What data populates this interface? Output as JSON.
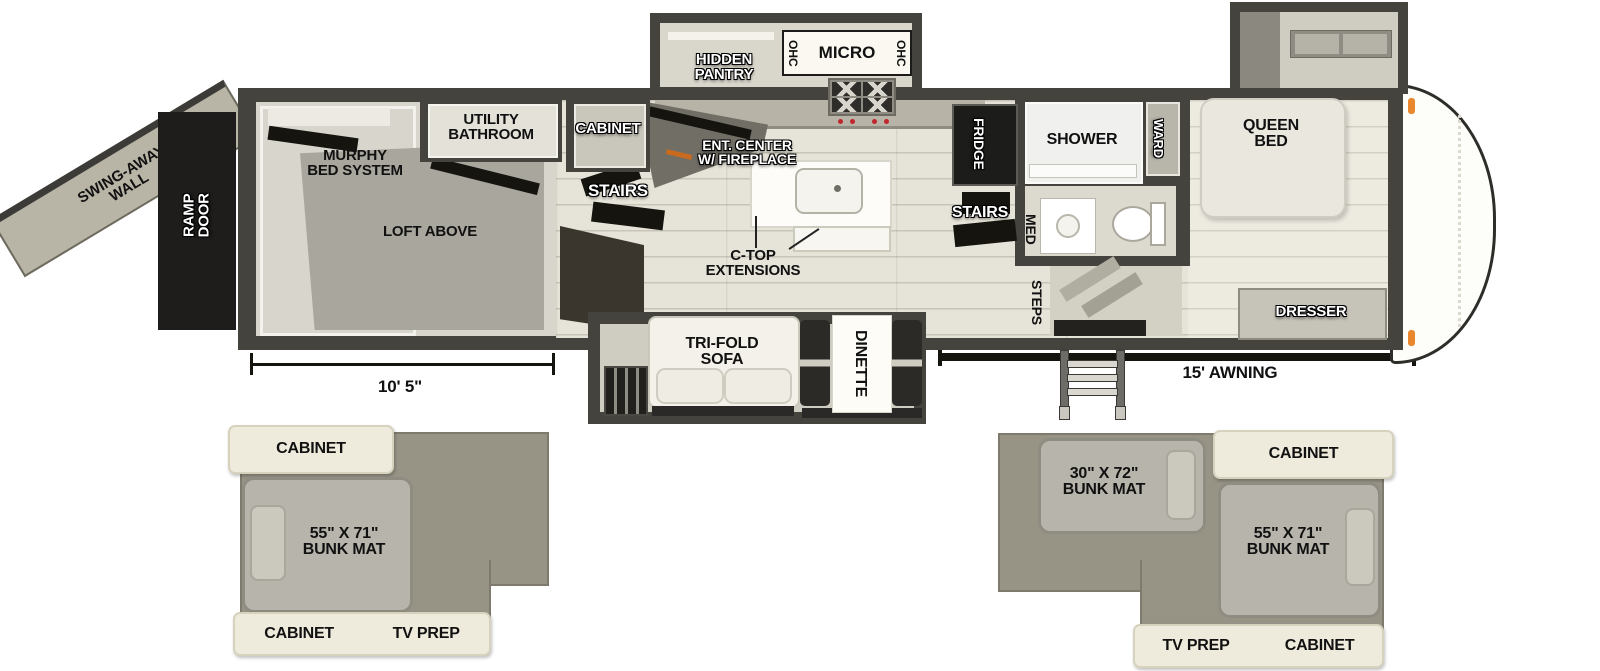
{
  "colors": {
    "wall": "#45433e",
    "floor": "#e6e3d8",
    "ramp_door_black": "#1e1d1b",
    "clearance_light_orange": "#e8872b",
    "inset_olive": "#979486",
    "inset_cream": "#efebdc"
  },
  "labels": {
    "swing_away_wall": "SWING-AWAY\nWALL",
    "ramp_door": "RAMP\nDOOR",
    "murphy_bed": "MURPHY\nBED SYSTEM",
    "loft_above": "LOFT ABOVE",
    "utility_bathroom": "UTILITY\nBATHROOM",
    "cabinet": "CABINET",
    "garage_dimension": "10' 5\"",
    "hidden_pantry": "HIDDEN\nPANTRY",
    "ohc_left": "OHC",
    "micro": "MICRO",
    "ohc_right": "OHC",
    "stairs_garage": "STAIRS",
    "ent_center": "ENT. CENTER\nW/ FIREPLACE",
    "ctop_extensions": "C-TOP\nEXTENSIONS",
    "fridge": "FRIDGE",
    "stairs_mid": "STAIRS",
    "shower": "SHOWER",
    "ward": "WARD",
    "med": "MED",
    "steps": "STEPS",
    "queen_bed": "QUEEN\nBED",
    "dresser": "DRESSER",
    "tri_fold_sofa": "TRI-FOLD\nSOFA",
    "dinette": "DINETTE",
    "awning": "15' AWNING"
  },
  "inset_left": {
    "cabinet_top": "CABINET",
    "bunk_mat": "55\" X 71\"\nBUNK MAT",
    "cabinet_bottom": "CABINET",
    "tv_prep": "TV PREP"
  },
  "inset_right": {
    "bunk_mat_small": "30\" X 72\"\nBUNK MAT",
    "cabinet_top": "CABINET",
    "bunk_mat_large": "55\" X 71\"\nBUNK MAT",
    "tv_prep": "TV PREP",
    "cabinet_bottom": "CABINET"
  }
}
